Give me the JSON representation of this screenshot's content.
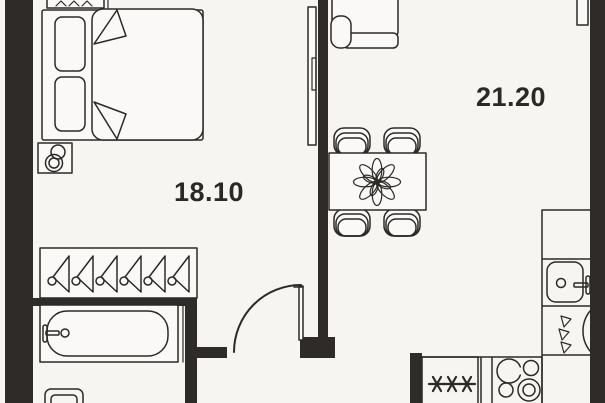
{
  "plan": {
    "kind": "apartment floor plan",
    "colors": {
      "background": "#f6f5f2",
      "wall": "#2e2b28",
      "line": "#2c2a27",
      "furniture_fill": "#faf9f7",
      "text": "#2b2825"
    },
    "rooms": [
      {
        "id": "bedroom",
        "area": "18.10"
      },
      {
        "id": "living-kitchen",
        "area": "21.20"
      }
    ],
    "fixtures": {
      "freezer_symbol": "***",
      "hanger_count": 6,
      "dining_chair_count": 4,
      "stove_burner_count": 4,
      "icons": [
        "radiator-icon",
        "double-bed-icon",
        "pillow-icon",
        "blanket-icon",
        "nightstand-lamp-icon",
        "tv-unit-icon",
        "sofa-icon",
        "dining-table-icon",
        "dining-chair-icon",
        "flower-centerpiece-icon",
        "wardrobe-hanger-icon",
        "bathtub-icon",
        "bath-faucet-icon",
        "toilet-icon",
        "door-swing-icon",
        "kitchen-counter-icon",
        "kitchen-sink-icon",
        "sink-faucet-icon",
        "washing-machine-icon",
        "water-drops-icon",
        "freezer-stars-icon",
        "stove-burners-icon"
      ]
    }
  }
}
